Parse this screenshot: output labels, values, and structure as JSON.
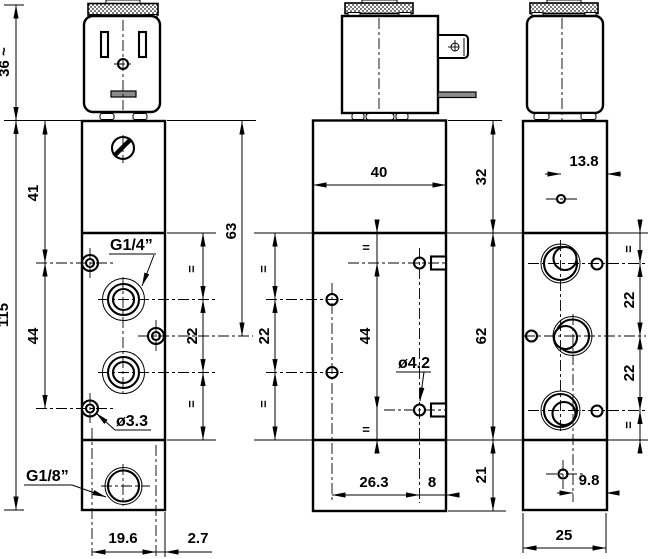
{
  "colors": {
    "line": "#000000",
    "background": "#ffffff",
    "metal_gray": "#8c8c8c"
  },
  "views": {
    "front": {
      "labels": {
        "dim_coil_height": "36 ~",
        "dim_41": "41",
        "dim_115": "115",
        "dim_44": "44",
        "dim_63": "63",
        "eq_upper": "=",
        "dim_22": "22",
        "eq_lower": "=",
        "port_top": "G1/4”",
        "hole_dia": "ø3.3",
        "port_bottom": "G1/8”",
        "dim_19_6": "19.6",
        "dim_2_7": "2.7"
      }
    },
    "side": {
      "labels": {
        "dim_40": "40",
        "dim_32": "32",
        "eq_left_upper": "=",
        "dim_22_left": "22",
        "eq_left_lower": "=",
        "eq_mid_upper": "=",
        "dim_44": "44",
        "eq_mid_lower": "=",
        "hole_dia": "ø4.2",
        "dim_62": "62",
        "dim_26_3": "26.3",
        "dim_8": "8",
        "dim_21": "21"
      }
    },
    "rear": {
      "labels": {
        "dim_13_8": "13.8",
        "eq_upper": "=",
        "dim_22_upper": "22",
        "dim_22_lower": "22",
        "eq_lower": "=",
        "dim_9_8": "9.8",
        "dim_25": "25"
      }
    }
  }
}
